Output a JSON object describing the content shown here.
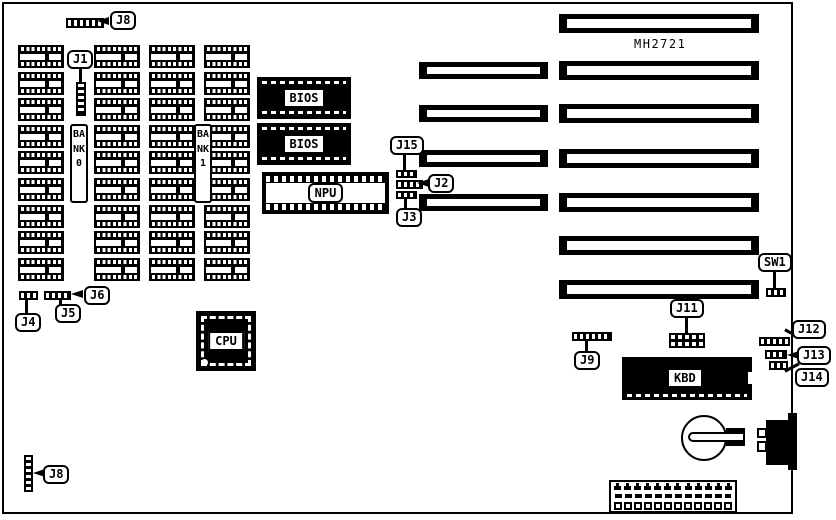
{
  "board": {
    "model": "MH2721"
  },
  "chips": {
    "bios1": "BIOS",
    "bios2": "BIOS",
    "npu": "NPU",
    "cpu": "CPU",
    "kbd": "KBD"
  },
  "memory": {
    "bank0": "BANK0",
    "bank1": "BANK1",
    "columns": 4,
    "chips_per_column": 9
  },
  "jumpers": {
    "j8_top": "J8",
    "j1": "J1",
    "j4": "J4",
    "j5": "J5",
    "j6": "J6",
    "j15": "J15",
    "j2": "J2",
    "j3": "J3",
    "sw1": "SW1",
    "j9": "J9",
    "j11": "J11",
    "j12": "J12",
    "j13": "J13",
    "j14": "J14",
    "j8_bottom": "J8"
  },
  "slots": {
    "left_column_count": 4,
    "right_column_count": 7
  },
  "power_connector": {
    "pin_count": 12
  },
  "colors": {
    "ink": "#000000",
    "paper": "#ffffff"
  }
}
